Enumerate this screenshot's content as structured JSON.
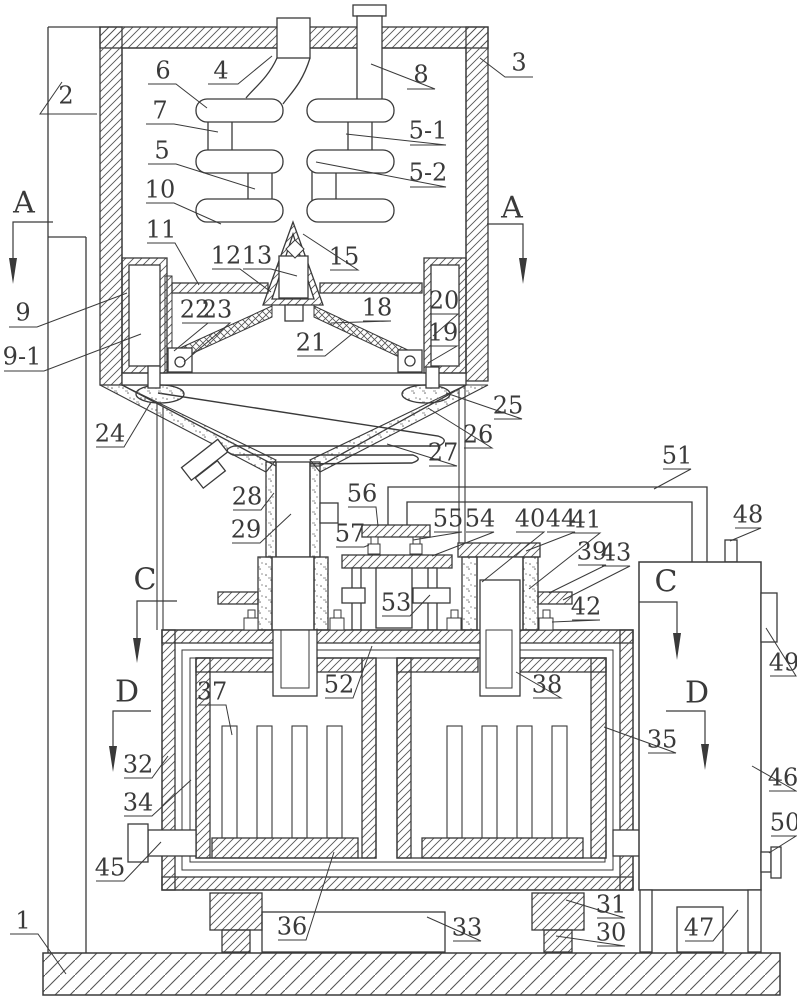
{
  "figure": {
    "type": "patent-mechanical-diagram",
    "background": "#ffffff",
    "line_color": "#3a3a3a",
    "hatch_color": "#555555",
    "label_font_px": 24,
    "section_font_px": 30
  },
  "part_labels": [
    {
      "id": "1",
      "text": "1",
      "x": 23,
      "y": 920,
      "leader": [
        [
          10,
          934
        ],
        [
          38,
          934
        ],
        [
          66,
          974
        ]
      ]
    },
    {
      "id": "2",
      "text": "2",
      "x": 66,
      "y": 95,
      "leader": [
        [
          97,
          114
        ],
        [
          40,
          114
        ],
        [
          62,
          82
        ]
      ]
    },
    {
      "id": "3",
      "text": "3",
      "x": 519,
      "y": 62,
      "leader": [
        [
          533,
          77
        ],
        [
          505,
          77
        ],
        [
          480,
          58
        ]
      ]
    },
    {
      "id": "4",
      "text": "4",
      "x": 221,
      "y": 70,
      "leader": [
        [
          208,
          84
        ],
        [
          238,
          84
        ],
        [
          272,
          56
        ]
      ]
    },
    {
      "id": "5",
      "text": "5",
      "x": 162,
      "y": 150,
      "leader": [
        [
          148,
          164
        ],
        [
          176,
          164
        ],
        [
          255,
          189
        ]
      ]
    },
    {
      "id": "5-1",
      "text": "5-1",
      "x": 428,
      "y": 130,
      "leader": [
        [
          410,
          145
        ],
        [
          446,
          145
        ],
        [
          346,
          134
        ]
      ]
    },
    {
      "id": "5-2",
      "text": "5-2",
      "x": 428,
      "y": 172,
      "leader": [
        [
          410,
          187
        ],
        [
          446,
          187
        ],
        [
          316,
          162
        ]
      ]
    },
    {
      "id": "6",
      "text": "6",
      "x": 163,
      "y": 70,
      "leader": [
        [
          148,
          84
        ],
        [
          176,
          84
        ],
        [
          207,
          108
        ]
      ]
    },
    {
      "id": "7",
      "text": "7",
      "x": 160,
      "y": 110,
      "leader": [
        [
          146,
          124
        ],
        [
          174,
          124
        ],
        [
          218,
          132
        ]
      ]
    },
    {
      "id": "8",
      "text": "8",
      "x": 421,
      "y": 74,
      "leader": [
        [
          407,
          89
        ],
        [
          435,
          89
        ],
        [
          371,
          64
        ]
      ]
    },
    {
      "id": "9",
      "text": "9",
      "x": 23,
      "y": 312,
      "leader": [
        [
          9,
          327
        ],
        [
          37,
          327
        ],
        [
          127,
          293
        ]
      ]
    },
    {
      "id": "9-1",
      "text": "9-1",
      "x": 22,
      "y": 356,
      "leader": [
        [
          4,
          371
        ],
        [
          44,
          371
        ],
        [
          141,
          334
        ]
      ]
    },
    {
      "id": "10",
      "text": "10",
      "x": 160,
      "y": 189,
      "leader": [
        [
          146,
          203
        ],
        [
          174,
          203
        ],
        [
          221,
          224
        ]
      ]
    },
    {
      "id": "11",
      "text": "11",
      "x": 161,
      "y": 229,
      "leader": [
        [
          147,
          243
        ],
        [
          175,
          243
        ],
        [
          199,
          285
        ]
      ]
    },
    {
      "id": "12",
      "text": "12",
      "x": 226,
      "y": 255,
      "leader": [
        [
          212,
          269
        ],
        [
          240,
          269
        ],
        [
          271,
          292
        ]
      ]
    },
    {
      "id": "13",
      "text": "13",
      "x": 257,
      "y": 255,
      "leader": [
        [
          243,
          269
        ],
        [
          271,
          269
        ],
        [
          297,
          276
        ]
      ]
    },
    {
      "id": "15",
      "text": "15",
      "x": 344,
      "y": 256,
      "leader": [
        [
          330,
          270
        ],
        [
          358,
          270
        ],
        [
          303,
          234
        ]
      ]
    },
    {
      "id": "18",
      "text": "18",
      "x": 377,
      "y": 307,
      "leader": [
        [
          363,
          321
        ],
        [
          391,
          321
        ],
        [
          331,
          323
        ]
      ]
    },
    {
      "id": "19",
      "text": "19",
      "x": 443,
      "y": 332,
      "leader": [
        [
          429,
          346
        ],
        [
          457,
          346
        ],
        [
          428,
          363
        ]
      ]
    },
    {
      "id": "20",
      "text": "20",
      "x": 444,
      "y": 300,
      "leader": [
        [
          430,
          314
        ],
        [
          458,
          314
        ],
        [
          433,
          336
        ]
      ]
    },
    {
      "id": "21",
      "text": "21",
      "x": 311,
      "y": 342,
      "leader": [
        [
          297,
          356
        ],
        [
          325,
          356
        ],
        [
          352,
          334
        ]
      ]
    },
    {
      "id": "22",
      "text": "22",
      "x": 195,
      "y": 309,
      "leader": [
        [
          182,
          323
        ],
        [
          208,
          323
        ],
        [
          174,
          351
        ]
      ]
    },
    {
      "id": "23",
      "text": "23",
      "x": 217,
      "y": 309,
      "leader": [
        [
          204,
          323
        ],
        [
          230,
          323
        ],
        [
          184,
          362
        ]
      ]
    },
    {
      "id": "24",
      "text": "24",
      "x": 110,
      "y": 433,
      "leader": [
        [
          96,
          447
        ],
        [
          124,
          447
        ],
        [
          151,
          402
        ]
      ]
    },
    {
      "id": "25",
      "text": "25",
      "x": 508,
      "y": 405,
      "leader": [
        [
          494,
          419
        ],
        [
          522,
          419
        ],
        [
          446,
          393
        ]
      ]
    },
    {
      "id": "26",
      "text": "26",
      "x": 478,
      "y": 434,
      "leader": [
        [
          464,
          448
        ],
        [
          492,
          448
        ],
        [
          428,
          408
        ]
      ]
    },
    {
      "id": "27",
      "text": "27",
      "x": 443,
      "y": 452,
      "leader": [
        [
          429,
          466
        ],
        [
          457,
          466
        ],
        [
          387,
          444
        ]
      ]
    },
    {
      "id": "28",
      "text": "28",
      "x": 247,
      "y": 496,
      "leader": [
        [
          233,
          510
        ],
        [
          261,
          510
        ],
        [
          274,
          493
        ]
      ]
    },
    {
      "id": "29",
      "text": "29",
      "x": 246,
      "y": 529,
      "leader": [
        [
          232,
          543
        ],
        [
          260,
          543
        ],
        [
          291,
          514
        ]
      ]
    },
    {
      "id": "30",
      "text": "30",
      "x": 611,
      "y": 932,
      "leader": [
        [
          597,
          946
        ],
        [
          625,
          946
        ],
        [
          556,
          936
        ]
      ]
    },
    {
      "id": "31",
      "text": "31",
      "x": 611,
      "y": 904,
      "leader": [
        [
          597,
          918
        ],
        [
          625,
          918
        ],
        [
          566,
          900
        ]
      ]
    },
    {
      "id": "32",
      "text": "32",
      "x": 138,
      "y": 764,
      "leader": [
        [
          124,
          778
        ],
        [
          152,
          778
        ],
        [
          168,
          756
        ]
      ]
    },
    {
      "id": "33",
      "text": "33",
      "x": 467,
      "y": 927,
      "leader": [
        [
          453,
          941
        ],
        [
          481,
          941
        ],
        [
          427,
          917
        ]
      ]
    },
    {
      "id": "34",
      "text": "34",
      "x": 138,
      "y": 802,
      "leader": [
        [
          124,
          816
        ],
        [
          152,
          816
        ],
        [
          191,
          780
        ]
      ]
    },
    {
      "id": "35",
      "text": "35",
      "x": 662,
      "y": 739,
      "leader": [
        [
          648,
          753
        ],
        [
          676,
          753
        ],
        [
          604,
          727
        ]
      ]
    },
    {
      "id": "36",
      "text": "36",
      "x": 292,
      "y": 926,
      "leader": [
        [
          278,
          940
        ],
        [
          306,
          940
        ],
        [
          334,
          852
        ]
      ]
    },
    {
      "id": "37",
      "text": "37",
      "x": 212,
      "y": 691,
      "leader": [
        [
          198,
          705
        ],
        [
          226,
          705
        ],
        [
          232,
          735
        ]
      ]
    },
    {
      "id": "38",
      "text": "38",
      "x": 547,
      "y": 684,
      "leader": [
        [
          533,
          698
        ],
        [
          561,
          698
        ],
        [
          516,
          672
        ]
      ]
    },
    {
      "id": "39",
      "text": "39",
      "x": 592,
      "y": 551,
      "leader": [
        [
          578,
          565
        ],
        [
          606,
          565
        ],
        [
          549,
          593
        ]
      ]
    },
    {
      "id": "40",
      "text": "40",
      "x": 530,
      "y": 518,
      "leader": [
        [
          516,
          532
        ],
        [
          544,
          532
        ],
        [
          482,
          582
        ]
      ]
    },
    {
      "id": "41",
      "text": "41",
      "x": 586,
      "y": 519,
      "leader": [
        [
          572,
          533
        ],
        [
          600,
          533
        ],
        [
          529,
          589
        ]
      ]
    },
    {
      "id": "42",
      "text": "42",
      "x": 586,
      "y": 606,
      "leader": [
        [
          572,
          620
        ],
        [
          600,
          620
        ],
        [
          552,
          622
        ]
      ]
    },
    {
      "id": "43",
      "text": "43",
      "x": 616,
      "y": 552,
      "leader": [
        [
          602,
          566
        ],
        [
          630,
          566
        ],
        [
          563,
          600
        ]
      ]
    },
    {
      "id": "44",
      "text": "44",
      "x": 561,
      "y": 518,
      "leader": [
        [
          547,
          532
        ],
        [
          575,
          532
        ],
        [
          526,
          551
        ]
      ]
    },
    {
      "id": "45",
      "text": "45",
      "x": 110,
      "y": 867,
      "leader": [
        [
          96,
          881
        ],
        [
          124,
          881
        ],
        [
          161,
          842
        ]
      ]
    },
    {
      "id": "46",
      "text": "46",
      "x": 783,
      "y": 777,
      "leader": [
        [
          769,
          791
        ],
        [
          796,
          791
        ],
        [
          752,
          766
        ]
      ]
    },
    {
      "id": "47",
      "text": "47",
      "x": 699,
      "y": 927,
      "leader": [
        [
          685,
          941
        ],
        [
          713,
          941
        ],
        [
          738,
          910
        ]
      ]
    },
    {
      "id": "48",
      "text": "48",
      "x": 748,
      "y": 514,
      "leader": [
        [
          735,
          528
        ],
        [
          761,
          528
        ],
        [
          730,
          541
        ]
      ]
    },
    {
      "id": "49",
      "text": "49",
      "x": 784,
      "y": 662,
      "leader": [
        [
          770,
          676
        ],
        [
          796,
          676
        ],
        [
          766,
          628
        ]
      ]
    },
    {
      "id": "50",
      "text": "50",
      "x": 785,
      "y": 822,
      "leader": [
        [
          771,
          836
        ],
        [
          796,
          836
        ],
        [
          769,
          853
        ]
      ]
    },
    {
      "id": "51",
      "text": "51",
      "x": 677,
      "y": 455,
      "leader": [
        [
          663,
          469
        ],
        [
          691,
          469
        ],
        [
          654,
          489
        ]
      ]
    },
    {
      "id": "52",
      "text": "52",
      "x": 339,
      "y": 684,
      "leader": [
        [
          325,
          698
        ],
        [
          353,
          698
        ],
        [
          372,
          646
        ]
      ]
    },
    {
      "id": "53",
      "text": "53",
      "x": 396,
      "y": 602,
      "leader": [
        [
          382,
          616
        ],
        [
          410,
          616
        ],
        [
          430,
          595
        ]
      ]
    },
    {
      "id": "54",
      "text": "54",
      "x": 480,
      "y": 518,
      "leader": [
        [
          466,
          532
        ],
        [
          494,
          532
        ],
        [
          432,
          556
        ]
      ]
    },
    {
      "id": "55",
      "text": "55",
      "x": 448,
      "y": 518,
      "leader": [
        [
          434,
          532
        ],
        [
          462,
          532
        ],
        [
          413,
          540
        ]
      ]
    },
    {
      "id": "56",
      "text": "56",
      "x": 362,
      "y": 493,
      "leader": [
        [
          348,
          507
        ],
        [
          376,
          507
        ],
        [
          378,
          526
        ]
      ]
    },
    {
      "id": "57",
      "text": "57",
      "x": 350,
      "y": 533,
      "leader": [
        [
          336,
          547
        ],
        [
          364,
          547
        ],
        [
          369,
          545
        ]
      ]
    }
  ],
  "section_markers": [
    {
      "text": "A",
      "x": 24,
      "y": 202,
      "line": [
        [
          53,
          222
        ],
        [
          13,
          222
        ],
        [
          13,
          258
        ]
      ],
      "arrow": [
        13,
        258,
        284
      ]
    },
    {
      "text": "A",
      "x": 512,
      "y": 207,
      "line": [
        [
          487,
          224
        ],
        [
          523,
          224
        ],
        [
          523,
          258
        ]
      ],
      "arrow": [
        523,
        258,
        284
      ]
    },
    {
      "text": "C",
      "x": 145,
      "y": 579,
      "line": [
        [
          177,
          601
        ],
        [
          137,
          601
        ],
        [
          137,
          638
        ]
      ],
      "arrow": [
        137,
        638,
        663
      ]
    },
    {
      "text": "C",
      "x": 666,
      "y": 581,
      "line": [
        [
          639,
          602
        ],
        [
          677,
          602
        ],
        [
          677,
          633
        ]
      ],
      "arrow": [
        677,
        633,
        660
      ]
    },
    {
      "text": "D",
      "x": 127,
      "y": 691,
      "line": [
        [
          151,
          711
        ],
        [
          113,
          711
        ],
        [
          113,
          746
        ]
      ],
      "arrow": [
        113,
        746,
        772
      ]
    },
    {
      "text": "D",
      "x": 697,
      "y": 692,
      "line": [
        [
          666,
          711
        ],
        [
          705,
          711
        ],
        [
          705,
          744
        ]
      ],
      "arrow": [
        705,
        744,
        770
      ]
    }
  ]
}
